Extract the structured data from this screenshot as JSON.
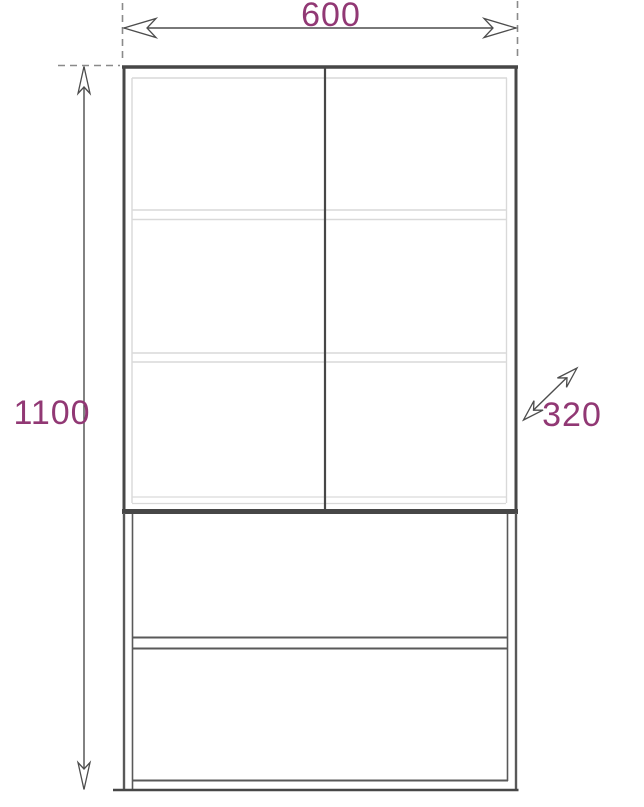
{
  "drawing": {
    "title": "Cabinet dimension drawing",
    "subject": "two-door display cabinet on drawer base, front elevation",
    "dimensions": {
      "width": {
        "label": "600",
        "orientation": "horizontal",
        "position": "top"
      },
      "height": {
        "label": "1100",
        "orientation": "vertical",
        "position": "left"
      },
      "depth": {
        "label": "320",
        "orientation": "diagonal",
        "position": "right"
      }
    },
    "colors": {
      "dimension_text": "#913874",
      "dimension_line": "#4d4d4d",
      "dashed_line": "#8a8a8a",
      "outline_dark": "#474747",
      "outline_mid": "#595959",
      "outline_light": "#d9d9d9",
      "background": "#ffffff"
    }
  }
}
